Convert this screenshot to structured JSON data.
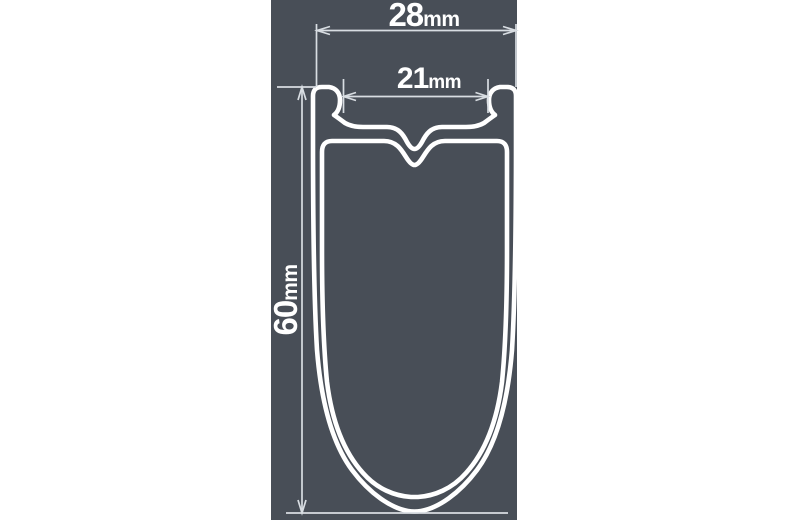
{
  "diagram": {
    "type": "rim-cross-section",
    "dimensions": {
      "outer_width": {
        "value": "28",
        "unit": "mm"
      },
      "bead_width": {
        "value": "21",
        "unit": "mm"
      },
      "depth": {
        "value": "60",
        "unit": "mm"
      }
    },
    "colors": {
      "page-bg": "#ffffff",
      "panel-bg": "#484E57",
      "outline": "#ffffff",
      "dimension-lines": "#D8DDE2",
      "label-text": "#ffffff"
    }
  }
}
